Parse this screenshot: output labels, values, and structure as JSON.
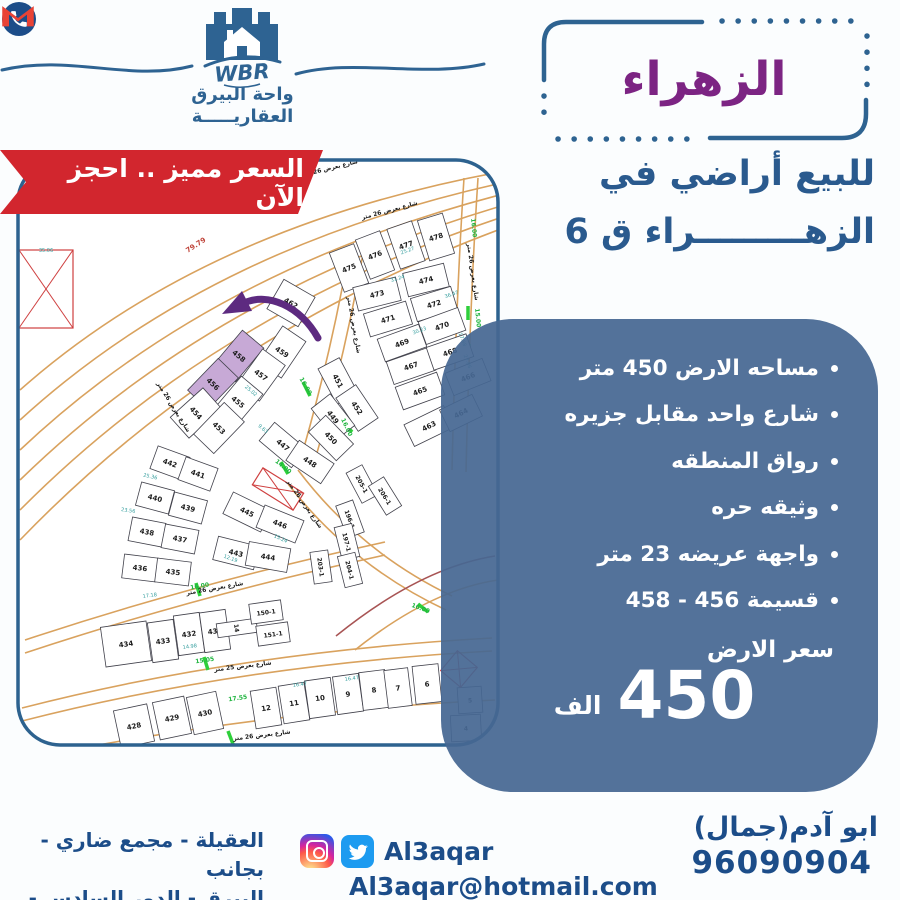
{
  "brand": {
    "wbr": "WBR",
    "line1": "واحة البيرق",
    "line2": "العقاريـــــة"
  },
  "ribbon": {
    "text": "السعر مميز .. احجز الآن",
    "color": "#d2262e"
  },
  "title": {
    "text": "الزهراء",
    "color": "#7c2483"
  },
  "subtitle": {
    "line1": "للبيع أراضي في",
    "line2": "الزهـــــــــراء ق 6"
  },
  "offer": {
    "panel_color": "rgba(70,103,146,0.93)",
    "bullets": [
      "مساحه الارض 450 متر",
      "شارع واحد مقابل جزيره",
      "رواق المنطقه",
      "وثيقه حره",
      "واجهة عريضه 23 متر",
      "قسيمة 456 - 458"
    ],
    "price_label": "سعر الارض",
    "price_value": "450",
    "price_unit": "الف"
  },
  "contact": {
    "name": "ابو آدم(جمال)",
    "phone": "96090904"
  },
  "social": {
    "handle": "Al3aqar",
    "email": "Al3aqar@hotmail.com"
  },
  "address": {
    "line1": "العقيلة - مجمع ضاري - بجانب",
    "line2": "البيرق - الدور السادس - مكتب 6"
  },
  "map": {
    "highlighted_plots": "456 - 458",
    "red_dim": {
      "t": "79.79",
      "x": 197,
      "y": 247,
      "r": -33
    },
    "street_labels": [
      {
        "t": "شارع بعرض 26 متر",
        "x": 390,
        "y": 212,
        "r": -15
      },
      {
        "t": "شارع بعرض 26 متر",
        "x": 330,
        "y": 170,
        "r": -14
      },
      {
        "t": "شارع بعرض 26 متر",
        "x": 471,
        "y": 272,
        "r": 82
      },
      {
        "t": "شارع بعرض 26 متر",
        "x": 352,
        "y": 325,
        "r": 80
      },
      {
        "t": "شارع بعرض 26 متر",
        "x": 172,
        "y": 408,
        "r": 58
      },
      {
        "t": "شارع بعرض 26 متر",
        "x": 303,
        "y": 505,
        "r": 55
      },
      {
        "t": "شارع بعرض 26 متر",
        "x": 215,
        "y": 590,
        "r": -10
      },
      {
        "t": "شارع بعرض 25 متر",
        "x": 243,
        "y": 668,
        "r": -7
      },
      {
        "t": "شارع بعرض 26 متر",
        "x": 262,
        "y": 737,
        "r": -7
      }
    ],
    "dims": [
      {
        "t": "25.27",
        "x": 408,
        "y": 252,
        "r": -20
      },
      {
        "t": "36.47",
        "x": 452,
        "y": 296,
        "r": -18
      },
      {
        "t": "17.88",
        "x": 461,
        "y": 340,
        "r": 70
      },
      {
        "t": "27.86",
        "x": 466,
        "y": 362,
        "r": 70
      },
      {
        "t": "31.24",
        "x": 398,
        "y": 280,
        "r": -18
      },
      {
        "t": "30.23",
        "x": 420,
        "y": 332,
        "r": -20
      },
      {
        "t": "25.36",
        "x": 150,
        "y": 478,
        "r": 12
      },
      {
        "t": "23.56",
        "x": 128,
        "y": 512,
        "r": 8
      },
      {
        "t": "17.18",
        "x": 150,
        "y": 597,
        "r": -8
      },
      {
        "t": "14.98",
        "x": 190,
        "y": 648,
        "r": -8
      },
      {
        "t": "16.47",
        "x": 300,
        "y": 686,
        "r": -8
      },
      {
        "t": "16.47",
        "x": 352,
        "y": 680,
        "r": -8
      },
      {
        "t": "35.06",
        "x": 46,
        "y": 252,
        "r": 0
      },
      {
        "t": "12.19",
        "x": 230,
        "y": 560,
        "r": 20
      },
      {
        "t": "15.24",
        "x": 280,
        "y": 540,
        "r": 25
      },
      {
        "t": "25.02",
        "x": 250,
        "y": 392,
        "r": 40
      },
      {
        "t": "9.63",
        "x": 262,
        "y": 430,
        "r": 40
      }
    ],
    "greens": [
      {
        "t": "16.00",
        "x": 472,
        "y": 228,
        "r": 85
      },
      {
        "t": "15.00",
        "x": 476,
        "y": 318,
        "r": 85
      },
      {
        "t": "16.00",
        "x": 304,
        "y": 387,
        "r": 60
      },
      {
        "t": "14.00",
        "x": 282,
        "y": 468,
        "r": 40
      },
      {
        "t": "16.00",
        "x": 345,
        "y": 428,
        "r": 65
      },
      {
        "t": "16.00",
        "x": 200,
        "y": 588,
        "r": -10
      },
      {
        "t": "15.05",
        "x": 205,
        "y": 662,
        "r": -8
      },
      {
        "t": "17.55",
        "x": 238,
        "y": 700,
        "r": -8
      },
      {
        "t": "16.00",
        "x": 420,
        "y": 610,
        "r": 20
      }
    ],
    "plots": [
      {
        "t": "475",
        "x": 349,
        "y": 268,
        "r": -21,
        "w": 26,
        "h": 42
      },
      {
        "t": "476",
        "x": 375,
        "y": 255,
        "r": -21,
        "w": 26,
        "h": 42
      },
      {
        "t": "477",
        "x": 406,
        "y": 245,
        "r": -19,
        "w": 26,
        "h": 42
      },
      {
        "t": "478",
        "x": 436,
        "y": 237,
        "r": -17,
        "w": 26,
        "h": 42
      },
      {
        "t": "473",
        "x": 377,
        "y": 294,
        "r": -14,
        "w": 44,
        "h": 24
      },
      {
        "t": "474",
        "x": 426,
        "y": 280,
        "r": -14,
        "w": 42,
        "h": 24
      },
      {
        "t": "471",
        "x": 388,
        "y": 319,
        "r": -17,
        "w": 44,
        "h": 24
      },
      {
        "t": "472",
        "x": 434,
        "y": 304,
        "r": -17,
        "w": 42,
        "h": 24
      },
      {
        "t": "469",
        "x": 402,
        "y": 343,
        "r": -20,
        "w": 44,
        "h": 24
      },
      {
        "t": "470",
        "x": 442,
        "y": 326,
        "r": -20,
        "w": 42,
        "h": 24
      },
      {
        "t": "467",
        "x": 411,
        "y": 366,
        "r": -19,
        "w": 44,
        "h": 24
      },
      {
        "t": "468",
        "x": 450,
        "y": 352,
        "r": -19,
        "w": 42,
        "h": 24
      },
      {
        "t": "465",
        "x": 420,
        "y": 391,
        "r": -20,
        "w": 44,
        "h": 24
      },
      {
        "t": "466",
        "x": 468,
        "y": 377,
        "r": -22,
        "w": 40,
        "h": 24
      },
      {
        "t": "463",
        "x": 429,
        "y": 426,
        "r": -26,
        "w": 44,
        "h": 24
      },
      {
        "t": "464",
        "x": 461,
        "y": 413,
        "r": -26,
        "w": 36,
        "h": 24
      },
      {
        "t": "462",
        "x": 291,
        "y": 303,
        "r": 30,
        "w": 36,
        "h": 34
      },
      {
        "t": "459",
        "x": 282,
        "y": 352,
        "r": 34,
        "w": 28,
        "h": 44
      },
      {
        "t": "458",
        "x": 239,
        "y": 356,
        "r": 40,
        "w": 28,
        "h": 44,
        "hl": true
      },
      {
        "t": "457",
        "x": 261,
        "y": 375,
        "r": 36,
        "w": 28,
        "h": 44
      },
      {
        "t": "456",
        "x": 213,
        "y": 384,
        "r": 44,
        "w": 28,
        "h": 44,
        "hl": true
      },
      {
        "t": "455",
        "x": 238,
        "y": 402,
        "r": 40,
        "w": 28,
        "h": 44
      },
      {
        "t": "454",
        "x": 196,
        "y": 413,
        "r": 48,
        "w": 28,
        "h": 44
      },
      {
        "t": "453",
        "x": 219,
        "y": 428,
        "r": 44,
        "w": 28,
        "h": 44
      },
      {
        "t": "451",
        "x": 338,
        "y": 381,
        "r": 62,
        "w": 40,
        "h": 24
      },
      {
        "t": "452",
        "x": 357,
        "y": 408,
        "r": 56,
        "w": 40,
        "h": 24
      },
      {
        "t": "449",
        "x": 333,
        "y": 417,
        "r": 52,
        "w": 40,
        "h": 24
      },
      {
        "t": "450",
        "x": 331,
        "y": 438,
        "r": 46,
        "w": 40,
        "h": 24
      },
      {
        "t": "447",
        "x": 283,
        "y": 445,
        "r": 40,
        "w": 42,
        "h": 24
      },
      {
        "t": "448",
        "x": 310,
        "y": 462,
        "r": 34,
        "w": 42,
        "h": 24
      },
      {
        "t": "",
        "x": 278,
        "y": 489,
        "r": 32,
        "w": 48,
        "h": 20,
        "red": true
      },
      {
        "t": "445",
        "x": 247,
        "y": 512,
        "r": 26,
        "w": 42,
        "h": 24
      },
      {
        "t": "446",
        "x": 280,
        "y": 524,
        "r": 22,
        "w": 42,
        "h": 24
      },
      {
        "t": "443",
        "x": 236,
        "y": 553,
        "r": 14,
        "w": 42,
        "h": 24
      },
      {
        "t": "444",
        "x": 268,
        "y": 557,
        "r": 10,
        "w": 42,
        "h": 24
      },
      {
        "t": "442",
        "x": 170,
        "y": 463,
        "r": 20,
        "w": 34,
        "h": 24
      },
      {
        "t": "441",
        "x": 198,
        "y": 474,
        "r": 20,
        "w": 34,
        "h": 24
      },
      {
        "t": "440",
        "x": 155,
        "y": 498,
        "r": 15,
        "w": 34,
        "h": 24
      },
      {
        "t": "439",
        "x": 188,
        "y": 508,
        "r": 15,
        "w": 34,
        "h": 24
      },
      {
        "t": "438",
        "x": 147,
        "y": 532,
        "r": 11,
        "w": 34,
        "h": 24
      },
      {
        "t": "437",
        "x": 180,
        "y": 539,
        "r": 11,
        "w": 34,
        "h": 24
      },
      {
        "t": "436",
        "x": 140,
        "y": 568,
        "r": 7,
        "w": 34,
        "h": 24
      },
      {
        "t": "435",
        "x": 173,
        "y": 572,
        "r": 7,
        "w": 34,
        "h": 24
      },
      {
        "t": "205-1",
        "x": 362,
        "y": 484,
        "r": 62,
        "w": 34,
        "h": 18,
        "fs": 6
      },
      {
        "t": "206-1",
        "x": 385,
        "y": 496,
        "r": 58,
        "w": 34,
        "h": 18,
        "fs": 6
      },
      {
        "t": "196-1",
        "x": 350,
        "y": 519,
        "r": 70,
        "w": 34,
        "h": 18,
        "fs": 6
      },
      {
        "t": "197-1",
        "x": 347,
        "y": 542,
        "r": 76,
        "w": 34,
        "h": 18,
        "fs": 6
      },
      {
        "t": "203-1",
        "x": 321,
        "y": 567,
        "r": 82,
        "w": 32,
        "h": 18,
        "fs": 6
      },
      {
        "t": "204-1",
        "x": 350,
        "y": 570,
        "r": 76,
        "w": 32,
        "h": 18,
        "fs": 6
      },
      {
        "t": "434",
        "x": 126,
        "y": 644,
        "r": -8,
        "w": 46,
        "h": 40
      },
      {
        "t": "433",
        "x": 163,
        "y": 641,
        "r": -8,
        "w": 26,
        "h": 40
      },
      {
        "t": "432",
        "x": 189,
        "y": 634,
        "r": -8,
        "w": 26,
        "h": 40
      },
      {
        "t": "431",
        "x": 215,
        "y": 631,
        "r": -8,
        "w": 26,
        "h": 40
      },
      {
        "t": "14",
        "x": 237,
        "y": 628,
        "r": 82,
        "w": 14,
        "h": 40,
        "fs": 6
      },
      {
        "t": "150-1",
        "x": 266,
        "y": 612,
        "r": -8,
        "w": 32,
        "h": 20,
        "fs": 6
      },
      {
        "t": "151-1",
        "x": 273,
        "y": 634,
        "r": -8,
        "w": 32,
        "h": 20,
        "fs": 6
      },
      {
        "t": "428",
        "x": 134,
        "y": 726,
        "r": -12,
        "w": 34,
        "h": 38
      },
      {
        "t": "429",
        "x": 172,
        "y": 718,
        "r": -12,
        "w": 32,
        "h": 38
      },
      {
        "t": "430",
        "x": 205,
        "y": 713,
        "r": -12,
        "w": 30,
        "h": 38
      },
      {
        "t": "12",
        "x": 266,
        "y": 708,
        "r": -9,
        "w": 26,
        "h": 38
      },
      {
        "t": "11",
        "x": 294,
        "y": 703,
        "r": -9,
        "w": 26,
        "h": 38
      },
      {
        "t": "10",
        "x": 320,
        "y": 698,
        "r": -8,
        "w": 26,
        "h": 38
      },
      {
        "t": "9",
        "x": 348,
        "y": 694,
        "r": -8,
        "w": 26,
        "h": 38
      },
      {
        "t": "8",
        "x": 374,
        "y": 690,
        "r": -7,
        "w": 26,
        "h": 38
      },
      {
        "t": "7",
        "x": 398,
        "y": 688,
        "r": -7,
        "w": 24,
        "h": 38
      },
      {
        "t": "6",
        "x": 427,
        "y": 684,
        "r": -6,
        "w": 26,
        "h": 38
      },
      {
        "t": "5",
        "x": 470,
        "y": 700,
        "r": -4,
        "w": 24,
        "h": 26,
        "fs": 6
      },
      {
        "t": "4",
        "x": 466,
        "y": 728,
        "r": -3,
        "w": 30,
        "h": 26,
        "fs": 6
      },
      {
        "t": "",
        "x": 46,
        "y": 289,
        "r": 0,
        "w": 54,
        "h": 78,
        "red": true
      },
      {
        "t": "",
        "x": 459,
        "y": 669,
        "r": 40,
        "w": 26,
        "h": 26,
        "red": true
      }
    ]
  }
}
